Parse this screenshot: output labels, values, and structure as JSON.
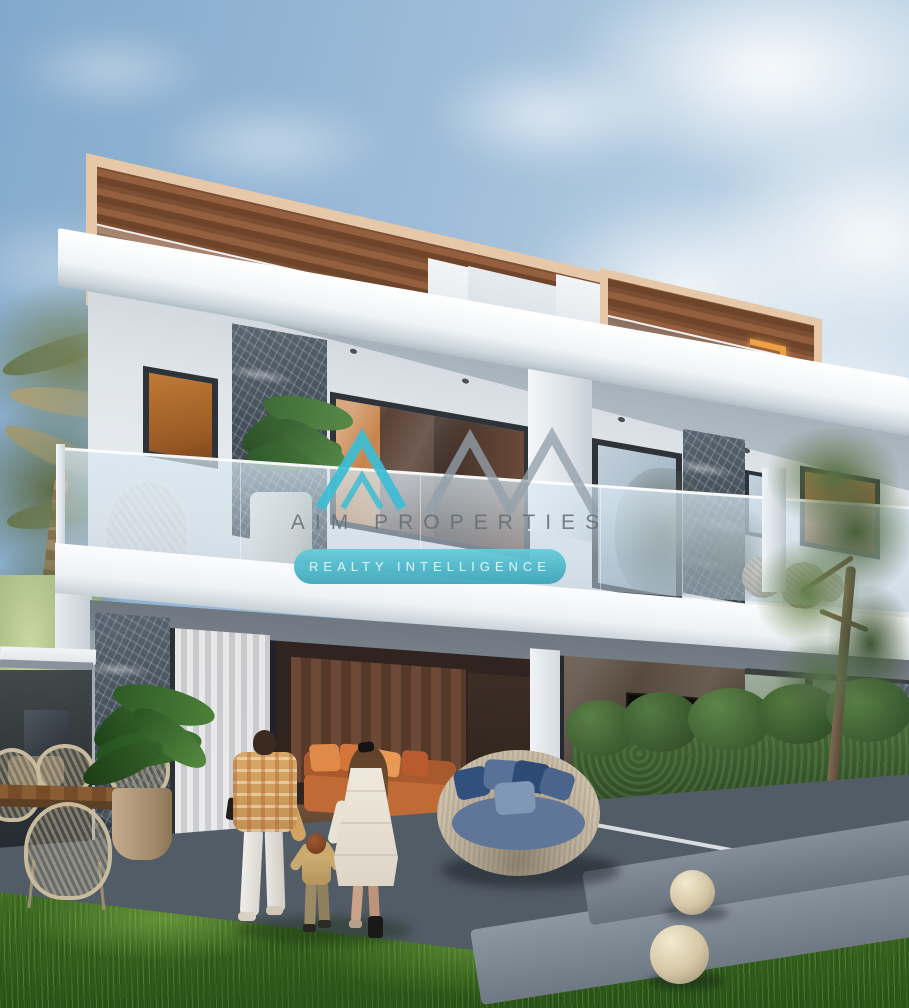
{
  "image": {
    "kind": "real-estate-architectural-rendering",
    "caption": "Modern two-storey twin villa with glass balcony, marble pillars and wood-slat roof pergolas; a family of three walks across the lawn toward the open living room; round rattan daybed with blue cushions, hedge, palm trees and sphere garden lamps"
  },
  "watermark": {
    "brand_name": "AIM PROPERTIES",
    "tagline": "REALTY INTELLIGENCE",
    "logo_name": "am-mountain-peaks-logo",
    "accent_color": "#3cbdd4",
    "logo_grey_color": "#94a0aa",
    "brand_text_color": "#626c76",
    "tagline_text_color": "#e8f8fc"
  },
  "palette": {
    "sky_blue": "#9dbcd8",
    "cloud_white": "#f4f8fb",
    "facade_white": "#f2f5f7",
    "wall_grey": "#dde2e6",
    "marble_dark": "#46525d",
    "wood_slat_brown": "#7c4f33",
    "pergola_frame_beige": "#e6c8a8",
    "window_amber": "#b4702d",
    "accent_orange": "#f0a143",
    "glass_tint": "#d6e7f2",
    "hedge_green": "#3a5730",
    "grass_green": "#4d7c2f",
    "patio_grey": "#525c66",
    "daybed_rattan": "#b7ab97",
    "cushion_blue": "#2c4a74",
    "sofa_terracotta": "#c06a36"
  }
}
